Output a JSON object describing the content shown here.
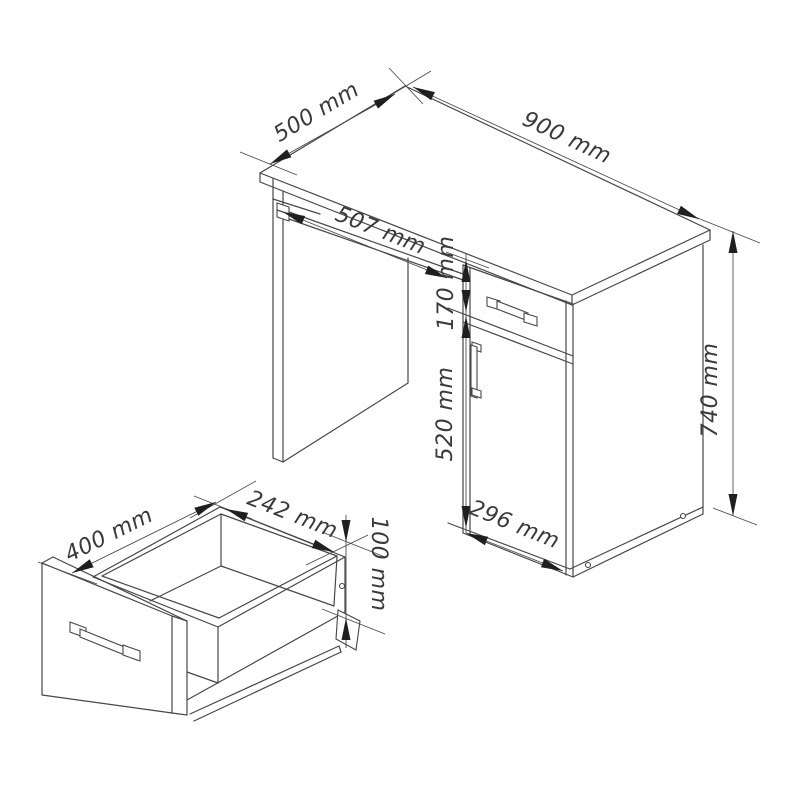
{
  "desk_dimensions": {
    "depth": "500 mm",
    "width": "900 mm",
    "tray_width": "507 mm",
    "drawer_front_height": "170 mm",
    "door_height": "520 mm",
    "cabinet_width": "296 mm",
    "height": "740 mm"
  },
  "drawer_dimensions": {
    "depth": "400 mm",
    "inner_width": "242 mm",
    "height": "100 mm"
  },
  "colors": {
    "background": "#ffffff",
    "line": "#474747",
    "arrow": "#1f1f1f",
    "text": "#3a3a3a"
  }
}
